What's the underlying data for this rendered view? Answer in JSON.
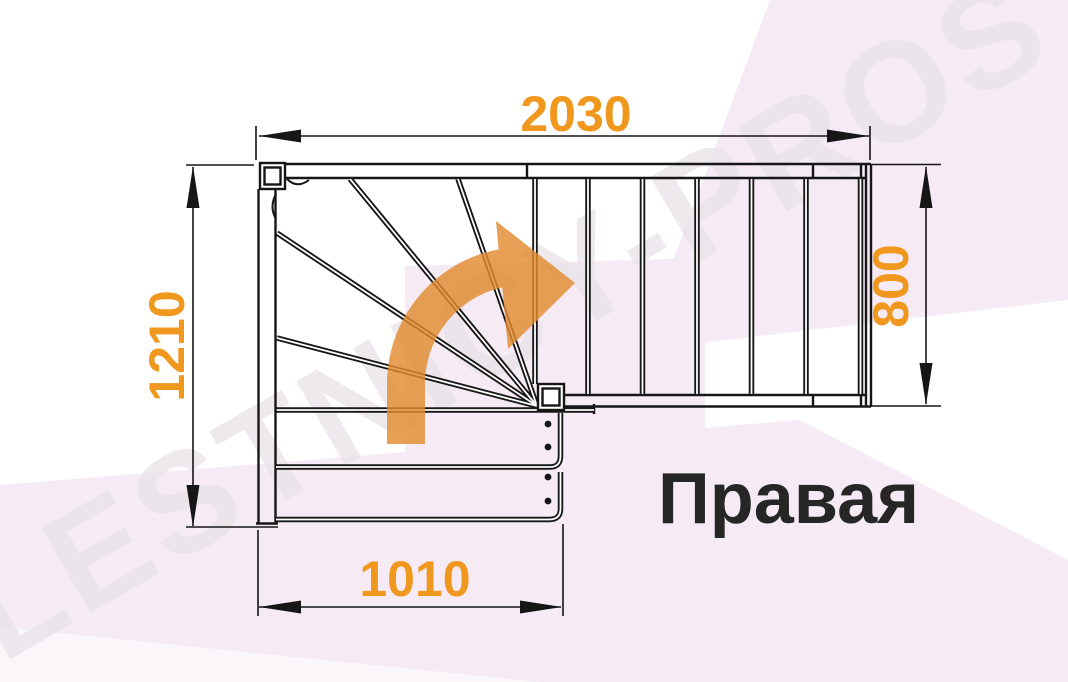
{
  "title_label": "Правая",
  "watermark": "LESTNICY-PROSTO.RU",
  "dimensions": {
    "top_width": "2030",
    "right_depth": "800",
    "left_height": "1210",
    "bottom_width": "1010"
  },
  "diagram": {
    "type": "staircase-plan-top-view",
    "turn_label": "Правая",
    "winder_steps": 5,
    "upper_flight_risers": 6,
    "lower_flight_treads": 2,
    "units": "mm"
  },
  "colors": {
    "dimension_text": "#F0971E",
    "direction_arrow": "#E28C30",
    "drawing_line": "#161616",
    "label_text": "#262626",
    "watermark_text": "#E8E2E8",
    "background_flare": "#F6EBF4"
  }
}
